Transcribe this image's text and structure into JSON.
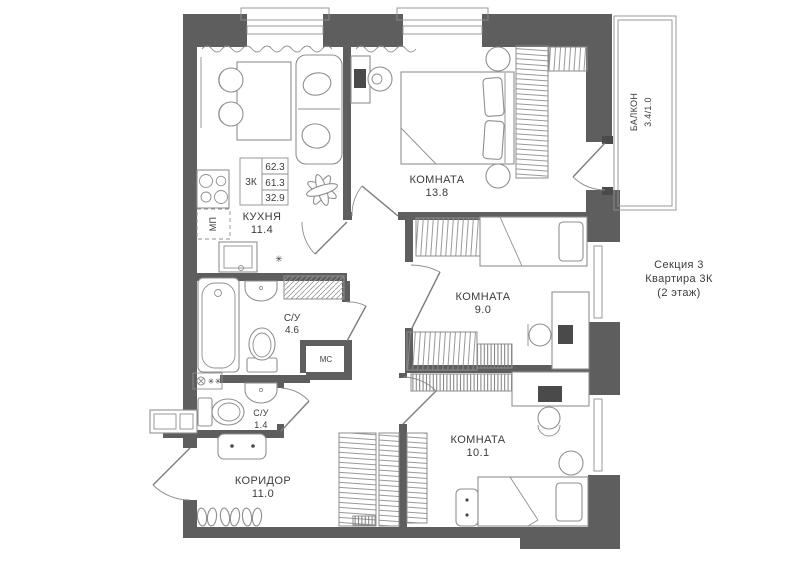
{
  "colors": {
    "wall": "#5e5e5e",
    "line": "#8f8f8f",
    "text": "#3c3c3c",
    "monitor": "#4a4a4a"
  },
  "info_table": {
    "type": "3К",
    "rows": [
      "62.3",
      "61.3",
      "32.9"
    ]
  },
  "note": {
    "line1": "Секция 3",
    "line2": "Квартира 3К",
    "line3": "(2 этаж)"
  },
  "rooms": {
    "kitchen": {
      "name": "КУХНЯ",
      "area": "11.4"
    },
    "bedroom": {
      "name": "КОМНАТА",
      "area": "13.8"
    },
    "room9": {
      "name": "КОМНАТА",
      "area": "9.0"
    },
    "room10": {
      "name": "КОМНАТА",
      "area": "10.1"
    },
    "bath": {
      "name": "С/У",
      "area": "4.6"
    },
    "wc": {
      "name": "С/У",
      "area": "1.4"
    },
    "corridor": {
      "name": "КОРИДОР",
      "area": "11.0"
    },
    "balcony": {
      "name": "БАЛКОН",
      "area": "3.4/1.0"
    }
  },
  "labels": {
    "mc": "МС",
    "mp": "МП"
  }
}
